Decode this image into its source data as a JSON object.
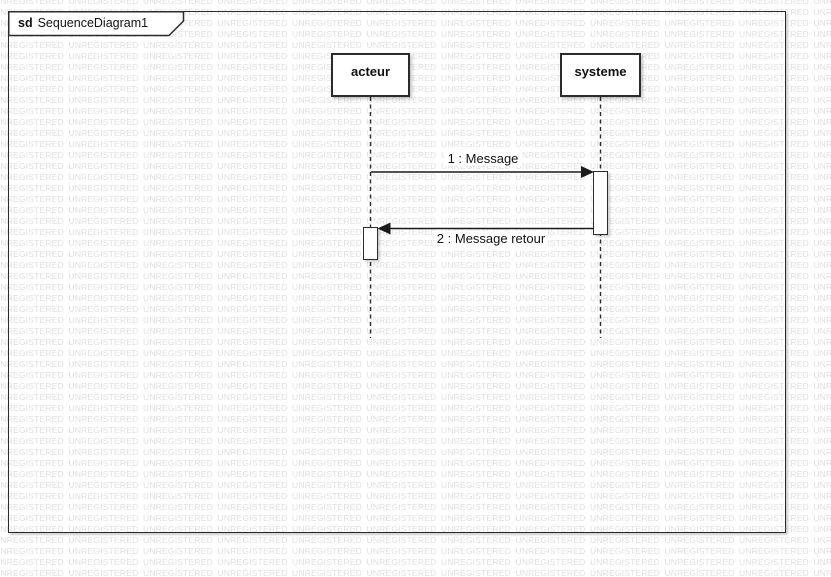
{
  "watermark": {
    "text": "UNREGISTERED",
    "color": "#e0e0e0"
  },
  "frame": {
    "keyword": "sd",
    "name": "SequenceDiagram1"
  },
  "lifelines": [
    {
      "label": "acteur"
    },
    {
      "label": "systeme"
    }
  ],
  "messages": [
    {
      "label": "1 : Message",
      "from": "acteur",
      "to": "systeme",
      "kind": "solid-filled-arrow"
    },
    {
      "label": "2 : Message retour",
      "from": "systeme",
      "to": "acteur",
      "kind": "solid-filled-arrow"
    }
  ],
  "colors": {
    "shape_border": "#2b2b2b",
    "shape_fill": "#ffffff",
    "text": "#111111",
    "watermark": "#e0e0e0"
  }
}
